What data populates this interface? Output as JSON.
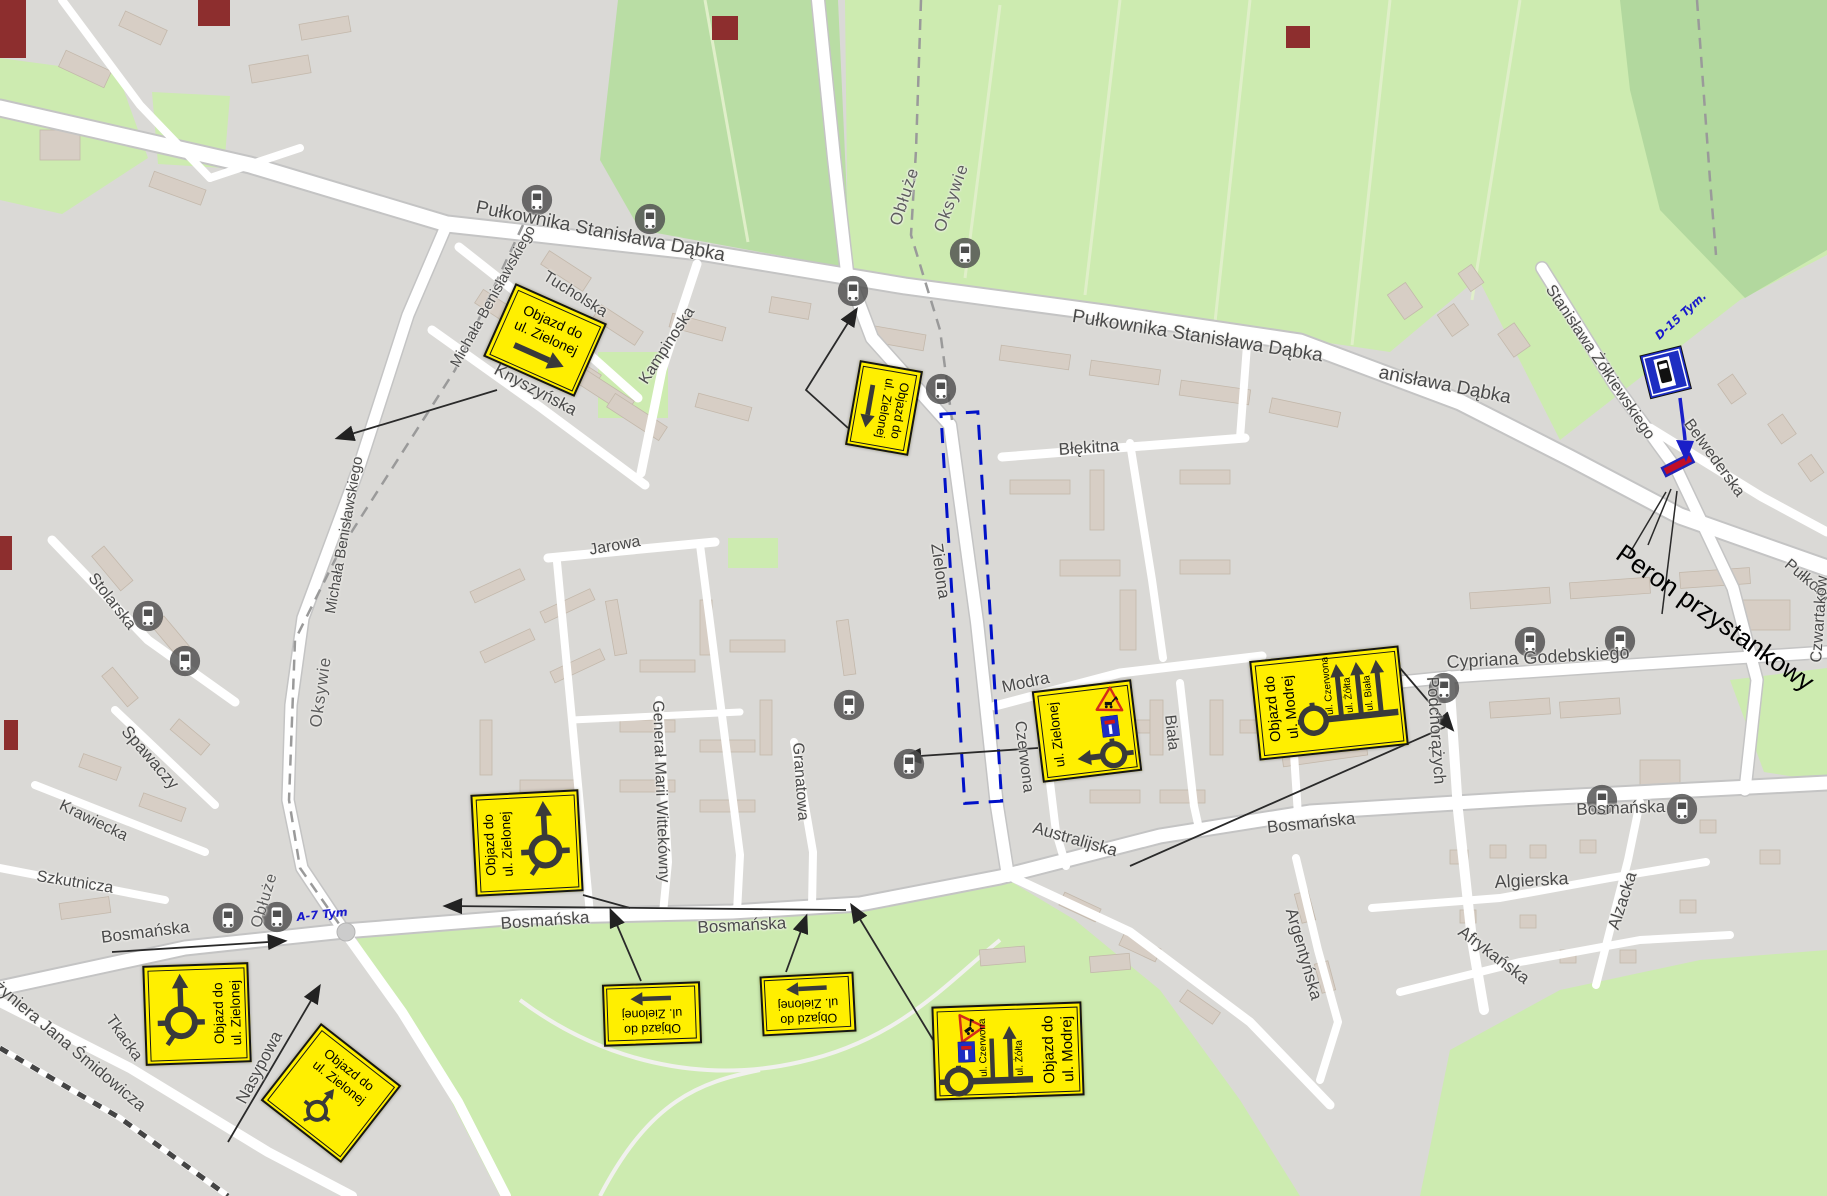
{
  "signs": {
    "detour_zielona": {
      "line1": "Objazd do",
      "line2": "ul. Zielonej"
    },
    "detour_modra": {
      "line1": "Objazd do",
      "line2": "ul. Modrej"
    },
    "closed_street": "ul. Zielonej",
    "branches": {
      "czerwona": "ul. Czerwona",
      "zolta": "ul. Żółta",
      "biala": "ul. Biała"
    }
  },
  "annotations": {
    "peron": "Peron przystankowy",
    "d15": "D-15  Tym.",
    "a7": "A-7   Tym"
  },
  "street_labels": [
    {
      "t": "Pułkownika Stanisława Dąbka",
      "x": 478,
      "y": 197,
      "r": 11,
      "s": 19
    },
    {
      "t": "Pułkownika Stanisława Dąbka",
      "x": 1074,
      "y": 306,
      "r": 9,
      "s": 19
    },
    {
      "t": "anisława Dąbka",
      "x": 1381,
      "y": 362,
      "r": 11,
      "s": 19
    },
    {
      "t": "Błękitna",
      "x": 1058,
      "y": 440,
      "r": -4,
      "s": 17
    },
    {
      "t": "Tucholska",
      "x": 549,
      "y": 268,
      "r": 32,
      "s": 16
    },
    {
      "t": "Kampinoska",
      "x": 636,
      "y": 378,
      "r": -57,
      "s": 16
    },
    {
      "t": "Knyszyńska",
      "x": 500,
      "y": 360,
      "r": 28,
      "s": 17
    },
    {
      "t": "Michała Benisławskiego",
      "x": 447,
      "y": 362,
      "r": -61,
      "s": 15
    },
    {
      "t": "Michała Benisławskiego",
      "x": 322,
      "y": 612,
      "r": -80,
      "s": 15
    },
    {
      "t": "Jarowa",
      "x": 588,
      "y": 542,
      "r": -10,
      "s": 16
    },
    {
      "t": "Stolarska",
      "x": 98,
      "y": 570,
      "r": 52,
      "s": 16
    },
    {
      "t": "Oksywie",
      "x": 306,
      "y": 726,
      "r": -82,
      "s": 17,
      "sp": 1
    },
    {
      "t": "Spawaczy",
      "x": 132,
      "y": 722,
      "r": 49,
      "s": 17
    },
    {
      "t": "Krawiecka",
      "x": 64,
      "y": 797,
      "r": 26,
      "s": 16
    },
    {
      "t": "Szkutnicza",
      "x": 38,
      "y": 868,
      "r": 9,
      "s": 16
    },
    {
      "t": "Obłuże",
      "x": 886,
      "y": 222,
      "r": -72,
      "s": 17,
      "sp": 1
    },
    {
      "t": "Oksywie",
      "x": 930,
      "y": 228,
      "r": -70,
      "s": 17,
      "sp": 1
    },
    {
      "t": "Obłuże",
      "x": 248,
      "y": 925,
      "r": -73,
      "s": 16,
      "sp": 1
    },
    {
      "t": "Bosmańska",
      "x": 100,
      "y": 928,
      "r": -7,
      "s": 17
    },
    {
      "t": "Bosmańska",
      "x": 500,
      "y": 914,
      "r": -4,
      "s": 17
    },
    {
      "t": "Bosmańska",
      "x": 697,
      "y": 918,
      "r": -3,
      "s": 17
    },
    {
      "t": "Bosmańska",
      "x": 1266,
      "y": 818,
      "r": -6,
      "s": 17
    },
    {
      "t": "Bosmańska",
      "x": 1576,
      "y": 800,
      "r": -2,
      "s": 17
    },
    {
      "t": "Zielona",
      "x": 946,
      "y": 542,
      "r": 82,
      "s": 17
    },
    {
      "t": "Modra",
      "x": 1000,
      "y": 678,
      "r": -12,
      "s": 17
    },
    {
      "t": "Czerwona",
      "x": 1028,
      "y": 720,
      "r": 83,
      "s": 16
    },
    {
      "t": "Biała",
      "x": 1178,
      "y": 714,
      "r": 84,
      "s": 16
    },
    {
      "t": "Granatowa",
      "x": 806,
      "y": 742,
      "r": 86,
      "s": 16
    },
    {
      "t": "Generał Marii Wittekówny",
      "x": 666,
      "y": 700,
      "r": 88,
      "s": 16
    },
    {
      "t": "Cypriana Godebskiego",
      "x": 1446,
      "y": 652,
      "r": -3,
      "s": 18
    },
    {
      "t": "Podchorążych",
      "x": 1442,
      "y": 676,
      "r": 86,
      "s": 17
    },
    {
      "t": "Stanisława Żółkiewskiego",
      "x": 1556,
      "y": 282,
      "r": 56,
      "s": 16
    },
    {
      "t": "Belwederska",
      "x": 1694,
      "y": 416,
      "r": 54,
      "s": 16
    },
    {
      "t": "Pułkownika",
      "x": 1792,
      "y": 556,
      "r": 40,
      "s": 16
    },
    {
      "t": "Czwartaków",
      "x": 1808,
      "y": 662,
      "r": -86,
      "s": 16
    },
    {
      "t": "Algierska",
      "x": 1494,
      "y": 872,
      "r": -3,
      "s": 18
    },
    {
      "t": "Alzacka",
      "x": 1604,
      "y": 926,
      "r": -72,
      "s": 17
    },
    {
      "t": "Afrykańska",
      "x": 1466,
      "y": 922,
      "r": 37,
      "s": 17
    },
    {
      "t": "Argentyńska",
      "x": 1300,
      "y": 906,
      "r": 74,
      "s": 17
    },
    {
      "t": "Australijska",
      "x": 1036,
      "y": 818,
      "r": 16,
      "s": 17
    },
    {
      "t": "Nasypowa",
      "x": 232,
      "y": 1098,
      "r": -62,
      "s": 17
    },
    {
      "t": "Inżyniera Jana Śmidowicza",
      "x": -8,
      "y": 968,
      "r": 40,
      "s": 17
    },
    {
      "t": "Tkacka",
      "x": 116,
      "y": 1012,
      "r": 55,
      "s": 16
    }
  ],
  "bus_stops": [
    [
      537,
      200
    ],
    [
      650,
      219
    ],
    [
      853,
      291
    ],
    [
      965,
      253
    ],
    [
      941,
      389
    ],
    [
      148,
      616
    ],
    [
      185,
      661
    ],
    [
      228,
      918
    ],
    [
      277,
      917
    ],
    [
      849,
      705
    ],
    [
      909,
      764
    ],
    [
      1444,
      688
    ],
    [
      1530,
      642
    ],
    [
      1620,
      641
    ],
    [
      1602,
      800
    ],
    [
      1682,
      809
    ]
  ],
  "colors": {
    "sign_bg": "#ffef00",
    "closure_dash": "#0011c8",
    "platform_fill": "#c00e28",
    "platform_border": "#2025b8",
    "note_blue": "#1a1acc",
    "grass": "#cdebb0",
    "building": "#d7cec5"
  }
}
